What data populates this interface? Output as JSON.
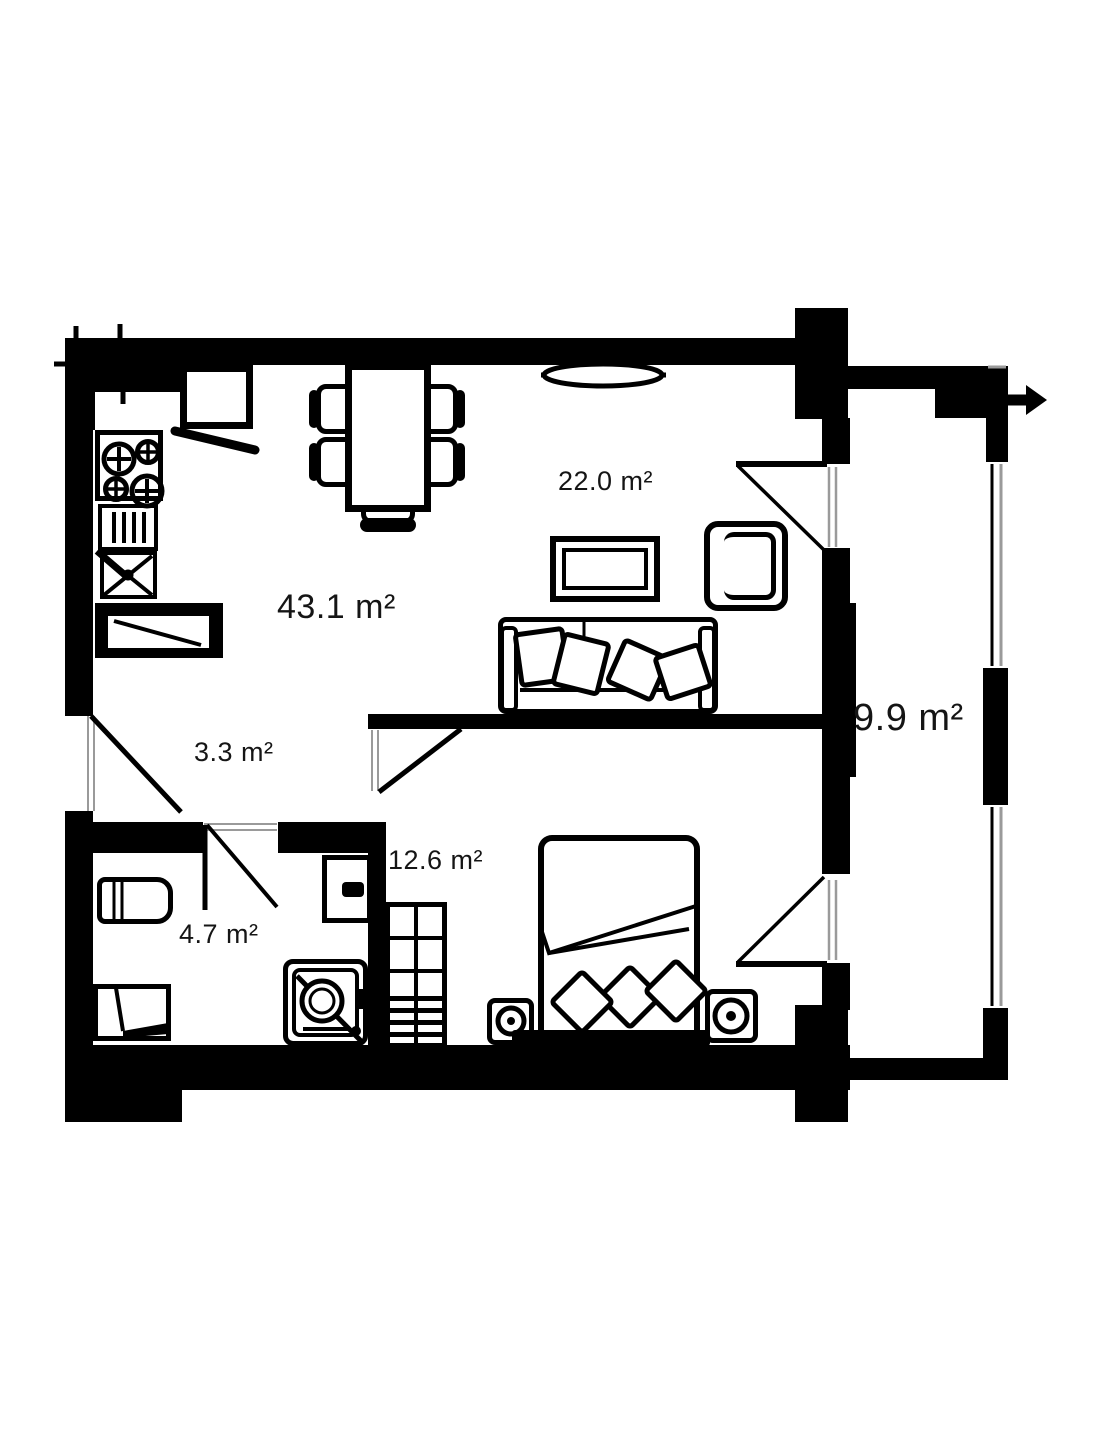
{
  "floorplan": {
    "type": "apartment-floor-plan",
    "unit": "m²",
    "total_visible_labels": 6,
    "rooms": [
      {
        "name": "kitchen-living-room",
        "area_label": "43.1 m²"
      },
      {
        "name": "living-area",
        "area_label": "22.0 m²"
      },
      {
        "name": "hallway",
        "area_label": "3.3 m²"
      },
      {
        "name": "bedroom",
        "area_label": "12.6 m²"
      },
      {
        "name": "bathroom",
        "area_label": "4.7 m²"
      },
      {
        "name": "balcony",
        "area_label": "9.9 m²"
      }
    ],
    "furniture": [
      "stove",
      "kitchen-sink",
      "dishwasher",
      "kitchen-counter",
      "fridge-cabinet",
      "dining-table",
      "chairs",
      "tv",
      "armchair",
      "sofa",
      "radiator",
      "bed",
      "pillows",
      "nightstands",
      "wardrobe",
      "toilet",
      "bath-cabinet",
      "washing-machine",
      "shower"
    ],
    "symbols": {
      "exit_arrow": "right-pointing entrance arrow at top right of balcony"
    }
  },
  "colors": {
    "wall": "#000000",
    "background": "#ffffff",
    "threshold": "#9a9a9a",
    "text": "#151515"
  }
}
